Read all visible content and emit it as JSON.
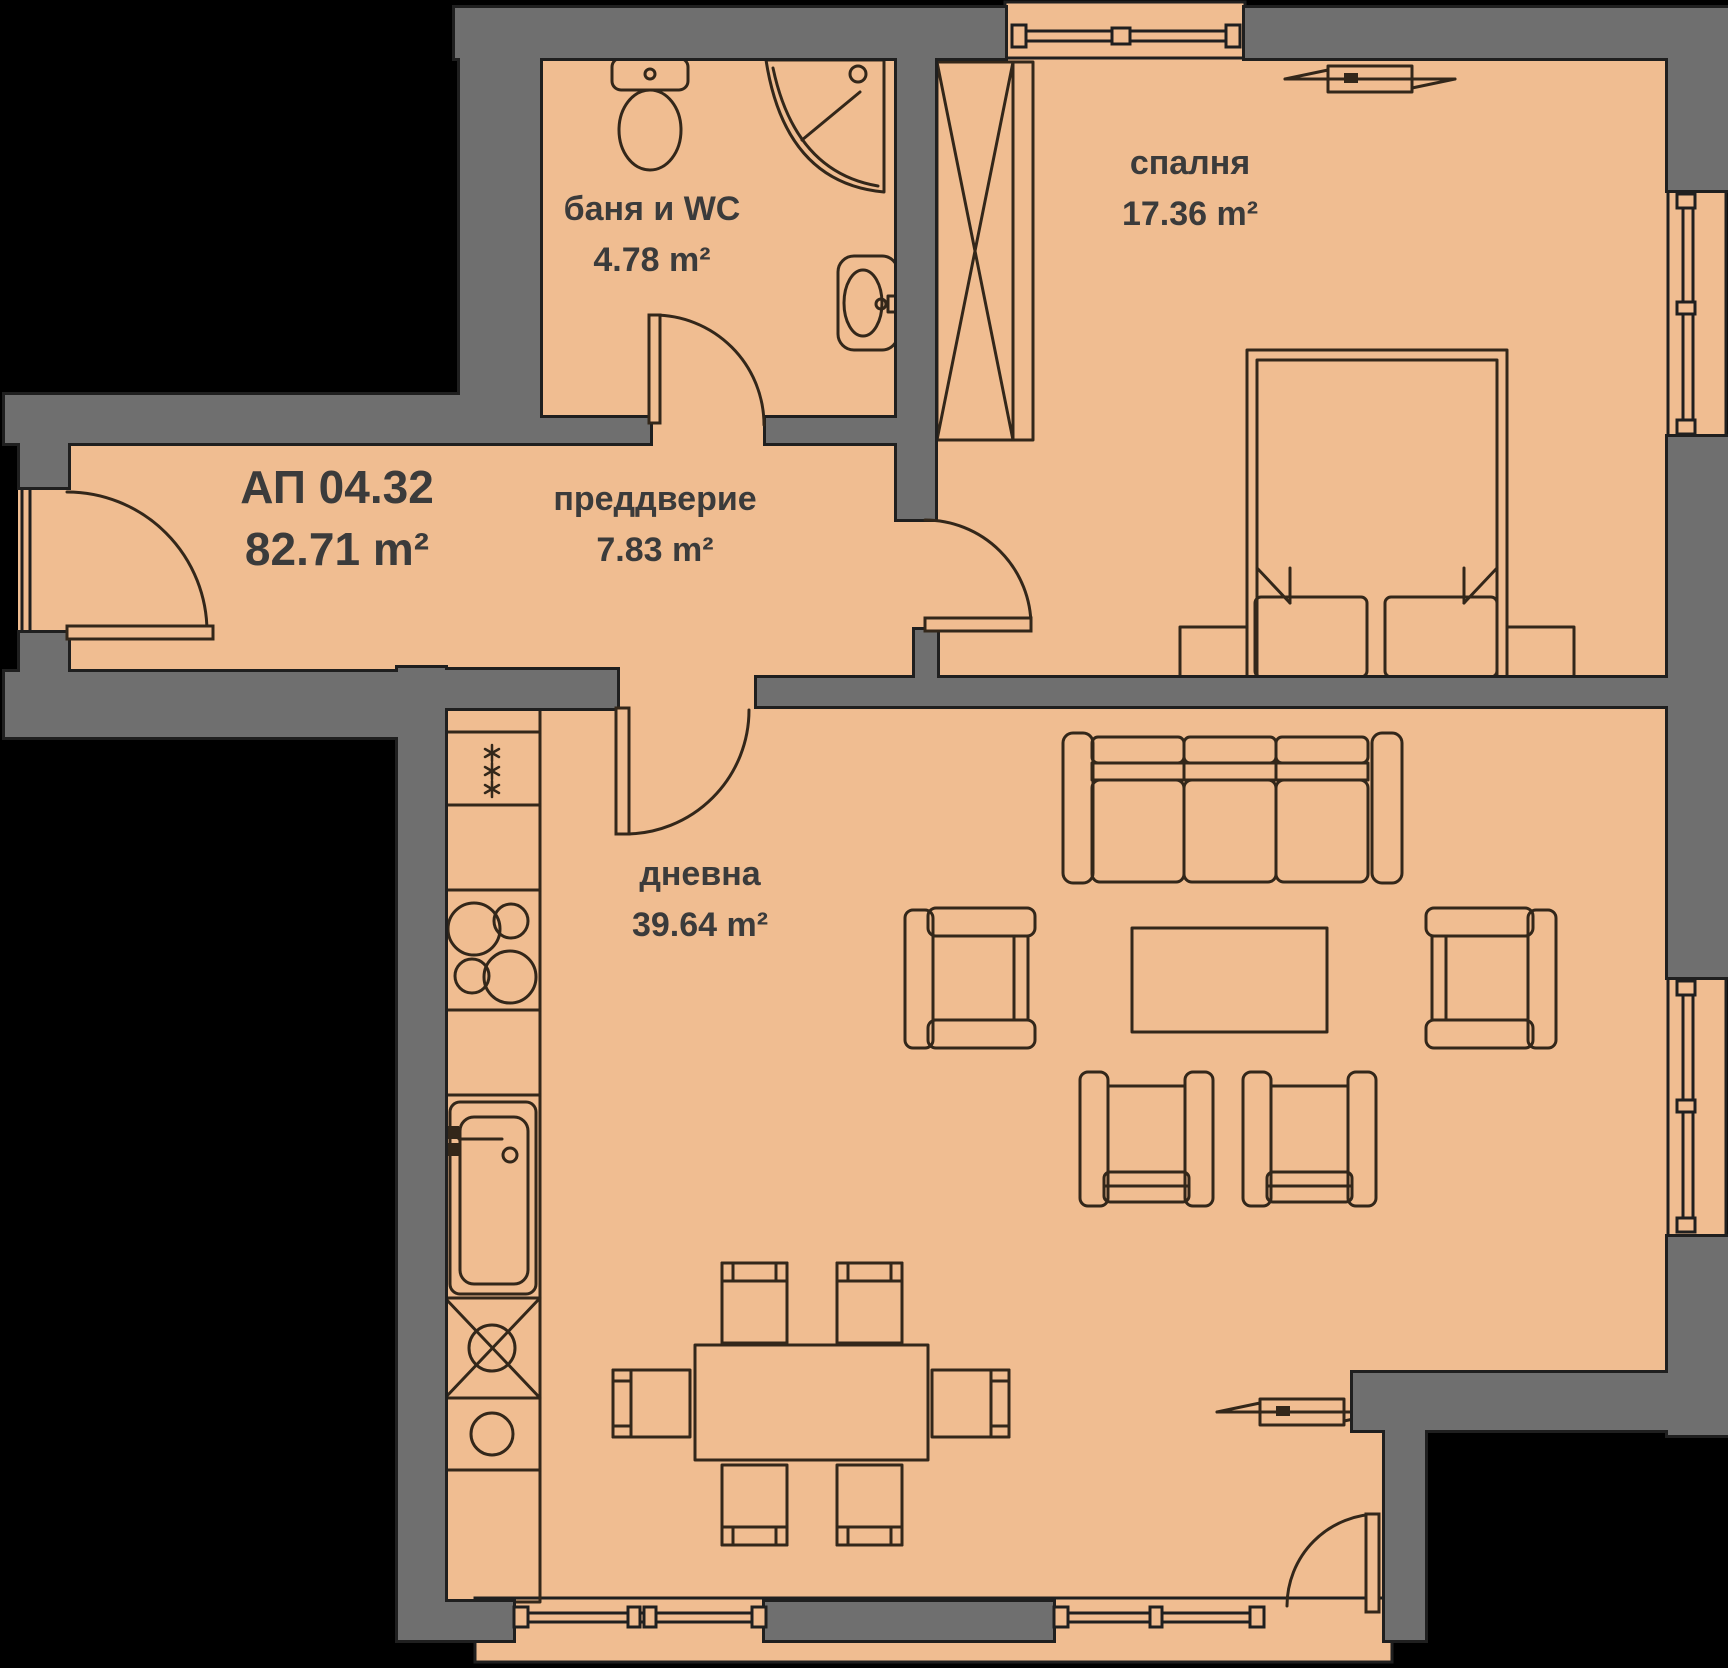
{
  "plan": {
    "apartment": {
      "code": "АП 04.32",
      "area": "82.71 m²"
    },
    "rooms": [
      {
        "id": "bathroom",
        "name": "баня и WC",
        "area": "4.78 m²"
      },
      {
        "id": "bedroom",
        "name": "спалня",
        "area": "17.36 m²"
      },
      {
        "id": "hallway",
        "name": "преддверие",
        "area": "7.83 m²"
      },
      {
        "id": "living",
        "name": "дневна",
        "area": "39.64 m²"
      }
    ],
    "colors": {
      "floor": "#f0bd91",
      "wall": "#6f6f6f",
      "outline": "#1f1f1f",
      "furn": "#33271a",
      "text": "#3b3b3b",
      "bg": "#000000"
    }
  }
}
